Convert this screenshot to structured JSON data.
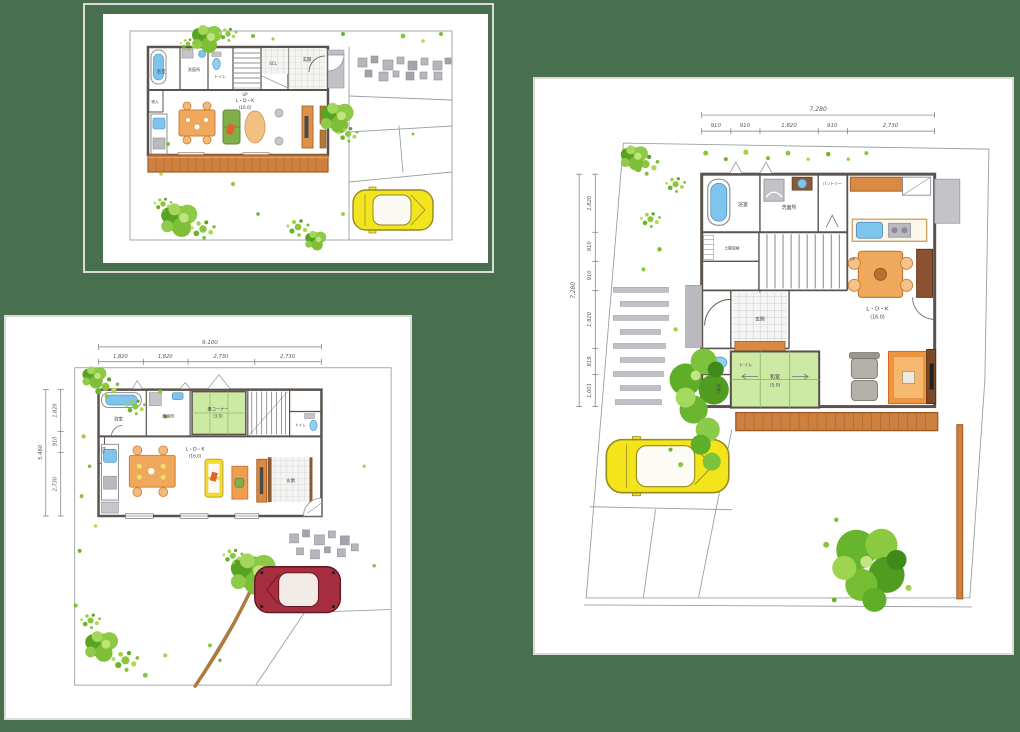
{
  "page": {
    "colors": {
      "background": "#48704e",
      "card_border": "#dcdbd7",
      "card_background": "#ffffff",
      "wall": "#5b534d",
      "deck_wood": "#cd8040",
      "tatami_green": "#cdeaa5",
      "fixture_blue": "#7ec5ee",
      "furniture_orange": "#f0a85c",
      "tree_green": "#6fb42e",
      "paving_gray": "#b6b6bd",
      "car_yellow": "#f2e41e",
      "car_red": "#a62e3e"
    }
  },
  "plans": {
    "plan_a": {
      "labels": {
        "bath": "浴室",
        "washroom": "洗面所",
        "toilet": "トイレ",
        "up": "UP",
        "scl": "SCL",
        "entrance": "玄関",
        "closet": "物入",
        "ldk": "L・D・K",
        "ldk_area": "(16.0)"
      }
    },
    "plan_b": {
      "dims_top": {
        "total": "9,100",
        "segments": [
          "1,820",
          "1,820",
          "2,730",
          "2,730"
        ]
      },
      "dims_left": {
        "total": "5,460",
        "segments": [
          "1,820",
          "910",
          "2,730"
        ]
      },
      "labels": {
        "bath": "浴室",
        "washroom": "洗面所",
        "tatami_corner": "畳コーナー",
        "tatami_area": "(3.0)",
        "toilet": "トイレ",
        "closet": "物入",
        "ldk": "L・D・K",
        "ldk_area": "(16.0)",
        "entrance": "玄関"
      }
    },
    "plan_c": {
      "dims_top": {
        "total": "7,280",
        "segments": [
          "910",
          "910",
          "1,820",
          "910",
          "2,730"
        ]
      },
      "dims_left": {
        "total": "7,280",
        "segments": [
          "1,820",
          "910",
          "910",
          "1,820",
          "819",
          "1,001"
        ]
      },
      "labels": {
        "bath": "浴室",
        "washroom": "洗面所",
        "pantry": "パントリー",
        "doma_storage": "土間収納",
        "entrance": "玄関",
        "toilet": "トイレ",
        "up": "UP",
        "hanging_closet": "吊押入",
        "washitsu": "和室",
        "washitsu_area": "(5.0)",
        "ldk": "L・D・K",
        "ldk_area": "(16.0)"
      }
    }
  }
}
